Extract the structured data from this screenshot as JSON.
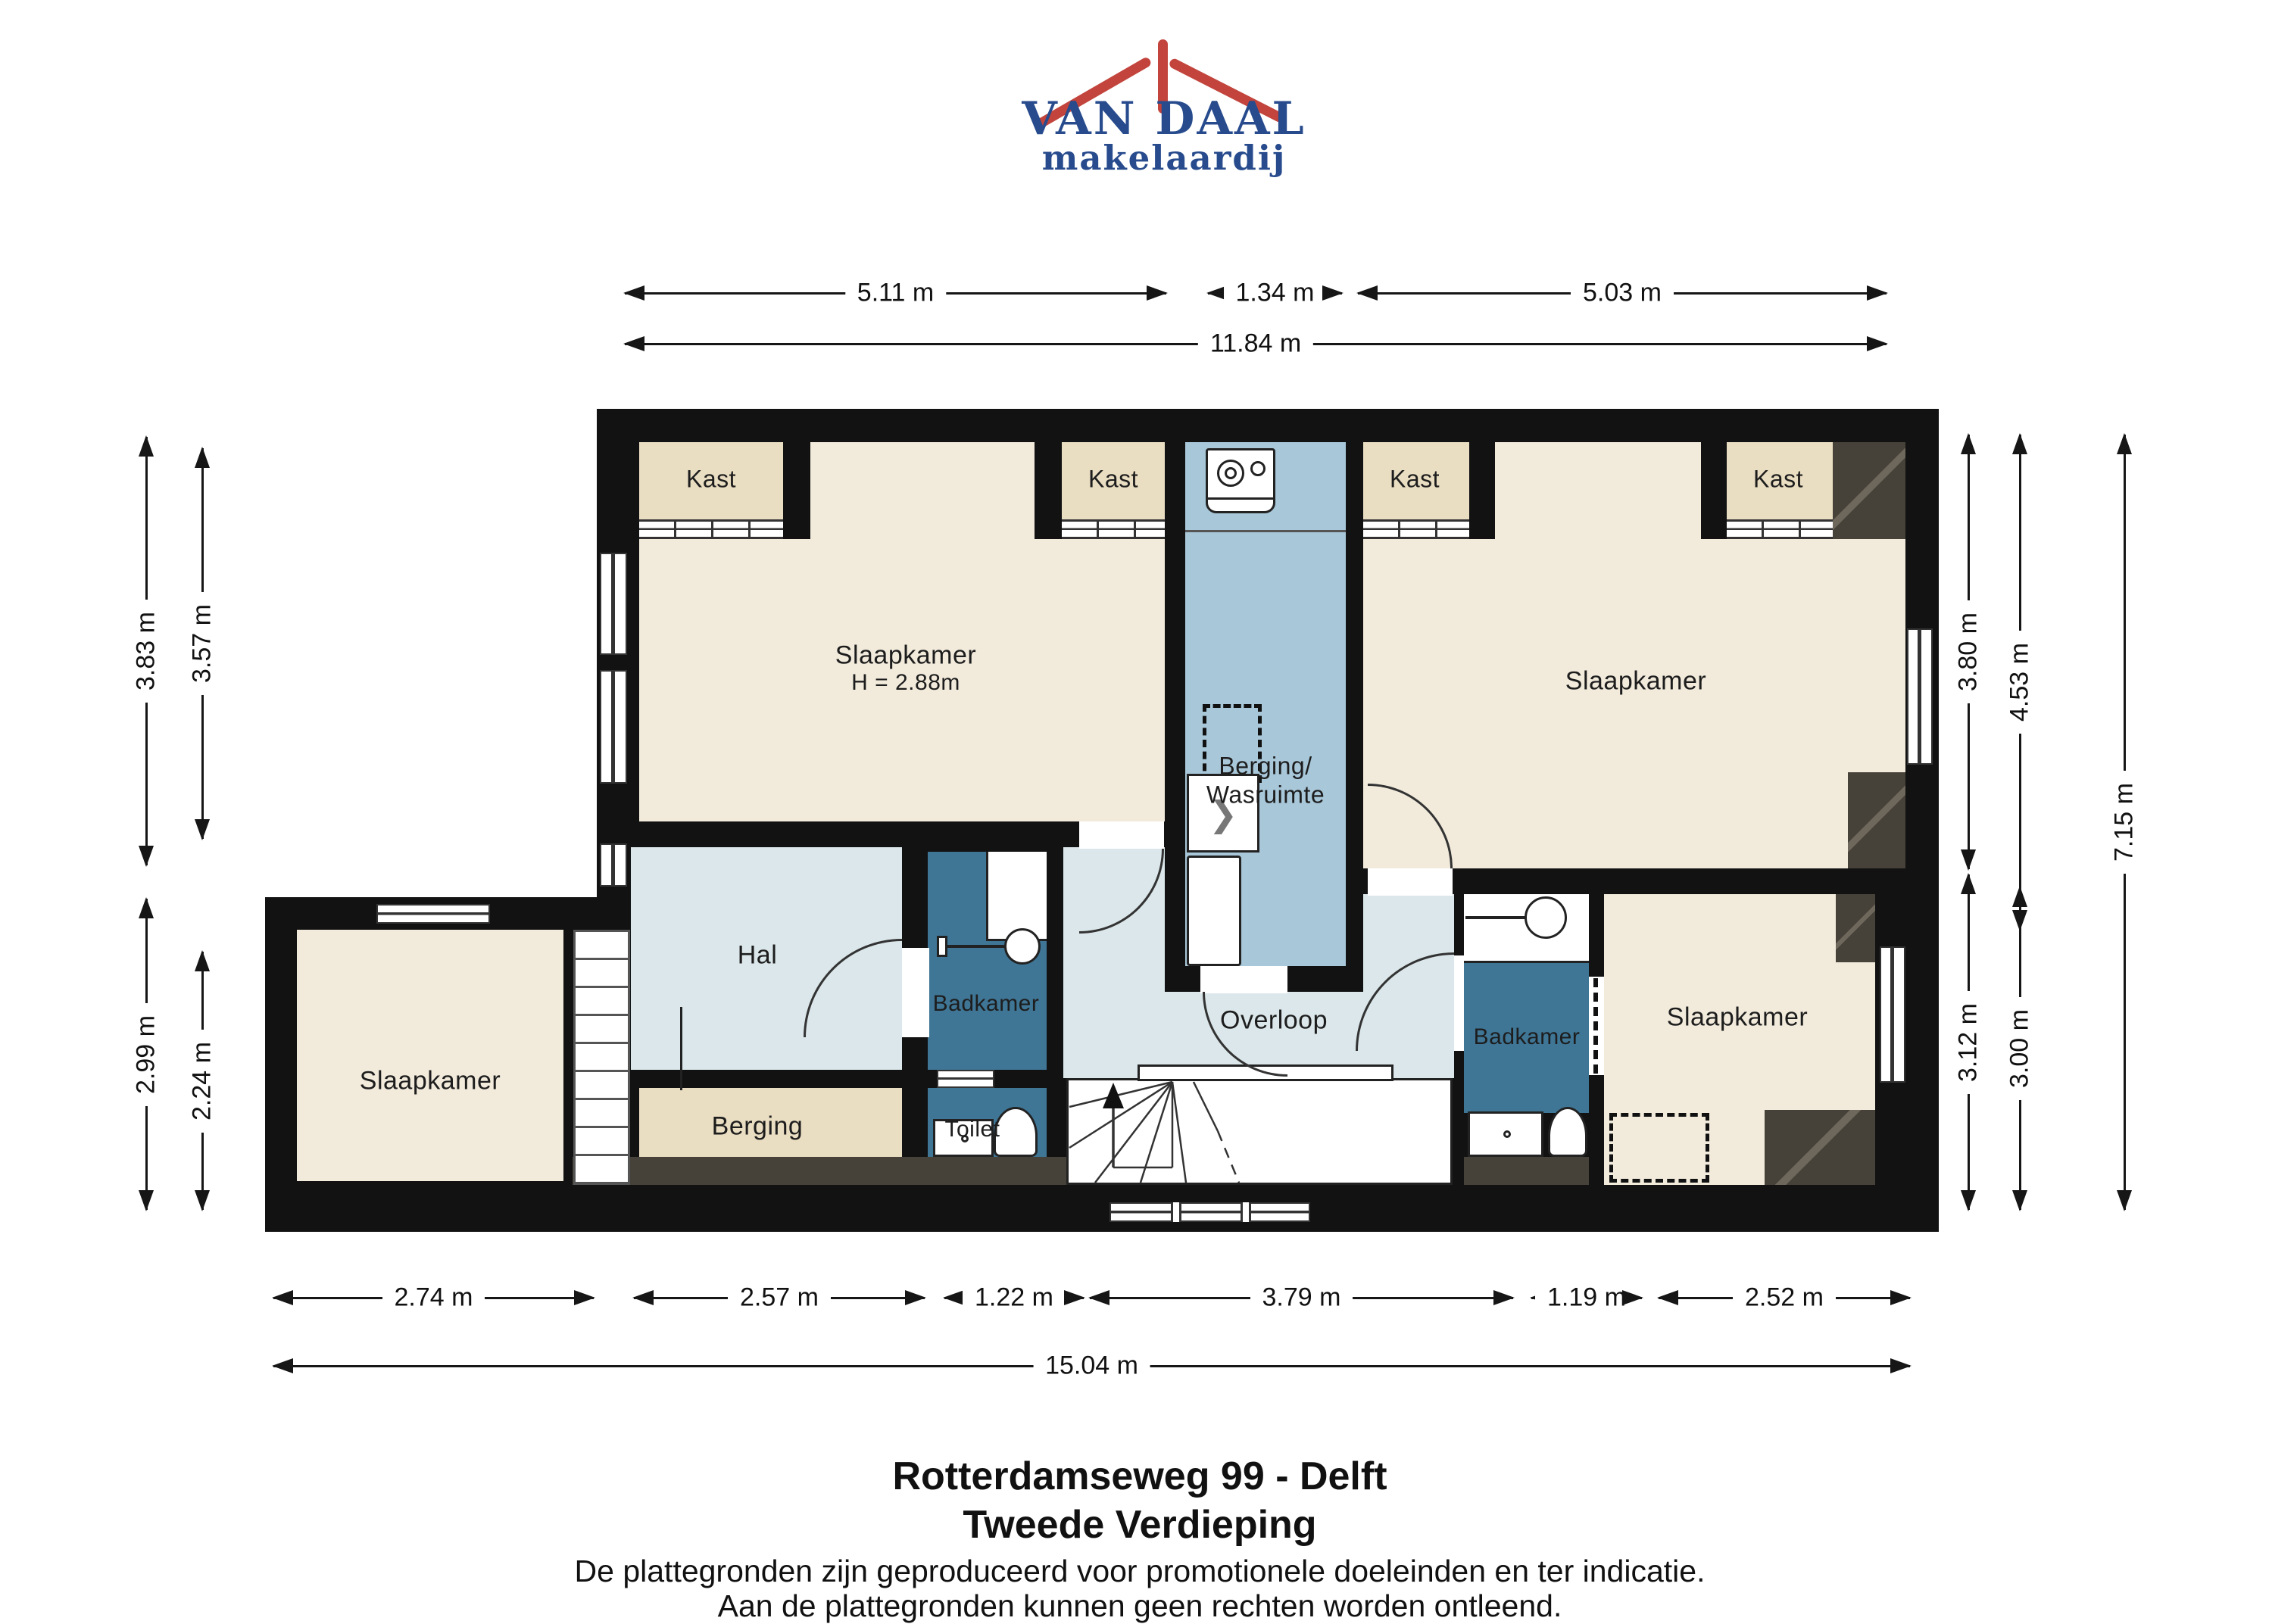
{
  "logo": {
    "line1": "VAN DAAL",
    "line2": "makelaardij",
    "red": "#c2443c",
    "blue": "#274b8d"
  },
  "rooms": {
    "kast1": "Kast",
    "kast2": "Kast",
    "kast3": "Kast",
    "kast4": "Kast",
    "slaapkamer_tl": "Slaapkamer",
    "slaapkamer_tl_height": "H = 2.88m",
    "berging_wasruimte_line1": "Berging/",
    "berging_wasruimte_line2": "Wasruimte",
    "slaapkamer_tr": "Slaapkamer",
    "hal": "Hal",
    "badkamer_left": "Badkamer",
    "toilet": "Toilet",
    "berging": "Berging",
    "overloop": "Overloop",
    "badkamer_right": "Badkamer",
    "slaapkamer_br": "Slaapkamer",
    "slaapkamer_bl": "Slaapkamer"
  },
  "dimensions": {
    "top": [
      "5.11 m",
      "1.34 m",
      "5.03 m"
    ],
    "top_total": "11.84 m",
    "bottom": [
      "2.74 m",
      "2.57 m",
      "1.22 m",
      "3.79 m",
      "1.19 m",
      "2.52 m"
    ],
    "bottom_total": "15.04 m",
    "left": [
      "3.83 m",
      "3.57 m",
      "2.99 m",
      "2.24 m"
    ],
    "right": [
      "3.80 m",
      "4.53 m",
      "7.15 m",
      "3.12 m",
      "3.00 m"
    ]
  },
  "footer": {
    "title": "Rotterdamseweg 99 - Delft",
    "subtitle": "Tweede Verdieping",
    "disclaimer1": "De plattegronden zijn geproduceerd voor promotionele doeleinden en ter indicatie.",
    "disclaimer2": "Aan de plattegronden kunnen geen rechten worden ontleend."
  },
  "icons": [
    "roof-logo-icon",
    "washing-machine-icon",
    "dryer-dashed-icon",
    "laundry-basket-icon",
    "cabinet-icon",
    "shower-icon",
    "mirror-icon",
    "faucet-icon",
    "toilet-icon",
    "sink-icon",
    "stairs-up-arrow-icon"
  ],
  "colors": {
    "wall": "#121212",
    "room_cream": "#f2ebdc",
    "closet_beige": "#e9ddc2",
    "laundry_blue": "#a8c7d9",
    "hall_pale_blue": "#dbe7ea",
    "bathroom_teal": "#3f7595",
    "roof_dark": "#474239",
    "dimension_line": "#161616",
    "logo_red": "#c2443c",
    "logo_blue": "#274b8d"
  }
}
